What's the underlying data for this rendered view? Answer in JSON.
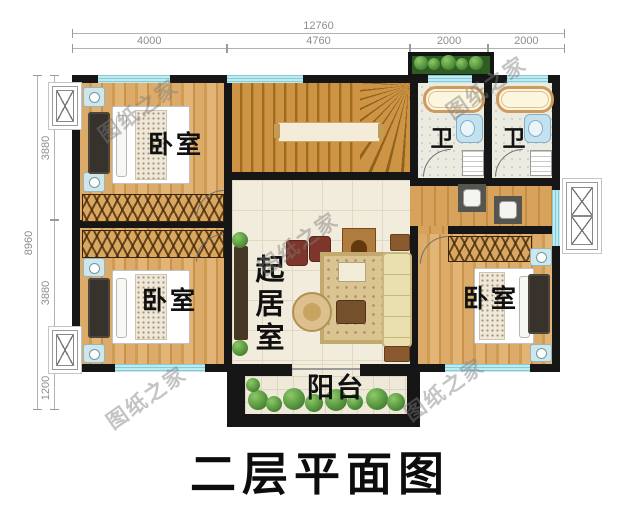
{
  "title": "二层平面图",
  "watermark": "图纸之家",
  "dimensions": {
    "top_total": "12760",
    "top_segments": [
      "4000",
      "4760",
      "2000",
      "2000"
    ],
    "left_total": "8960",
    "left_segments": [
      "3880",
      "3880",
      "1200"
    ]
  },
  "rooms": {
    "bedroom_top_left": "卧室",
    "bedroom_bottom_left": "卧室",
    "bedroom_right": "卧室",
    "bathroom_left": "卫",
    "bathroom_right": "卫",
    "living_room": "起居室",
    "balcony": "阳台"
  },
  "colors": {
    "wall": "#161616",
    "window": "#bfeaf0",
    "wood_floor": "#d8a765",
    "stair_wood": "#c9913f",
    "tile_floor": "#f2ecdc",
    "plant_green": "#4e9140",
    "dimension_text": "#8e8e8e",
    "label_text": "#111111"
  }
}
